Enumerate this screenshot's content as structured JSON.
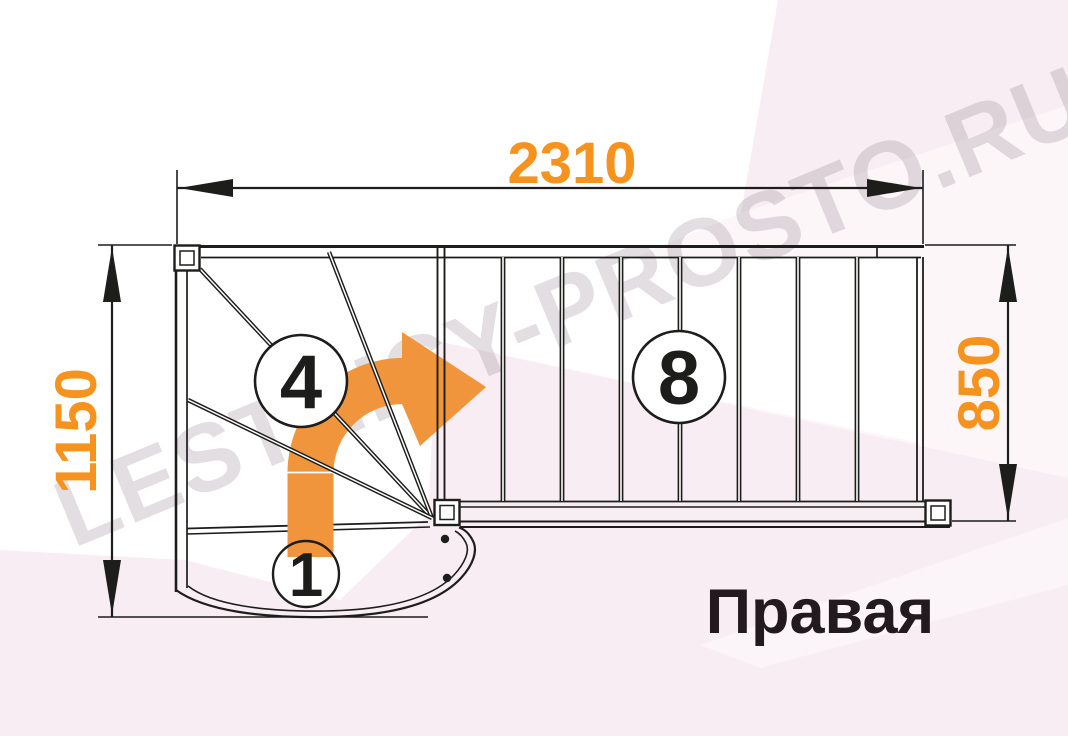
{
  "diagram": {
    "type_label": "stair-plan-top-view",
    "title": "Правая",
    "watermark": "LESTNICY-PROSTO.RU",
    "dimensions": {
      "total_length_mm": "2310",
      "total_width_mm": "1150",
      "flight_width_mm": "850"
    },
    "step_counts": {
      "winder_steps": "4",
      "straight_steps": "8",
      "first_step": "1"
    },
    "colors": {
      "dimension_text": "#f6921e",
      "arrow_fill": "#f0953b",
      "line": "#1d1d1b",
      "background_pink": "#f8edf3",
      "title_text": "#231a1f"
    }
  }
}
